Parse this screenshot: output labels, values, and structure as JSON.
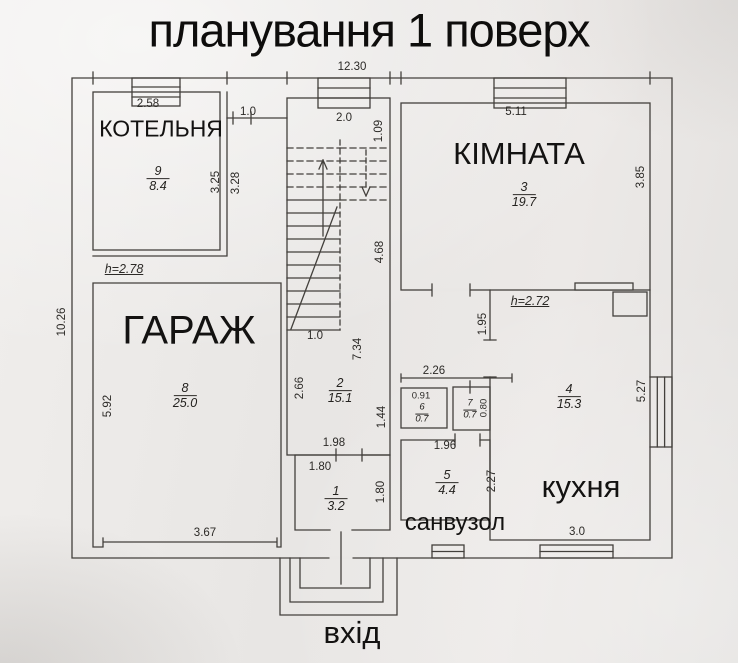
{
  "title": "планування 1 поверх",
  "entrance": {
    "label": "вхід"
  },
  "rooms": {
    "kotelnya": {
      "name": "КОТЕЛЬНЯ",
      "number": "9",
      "area": "8.4",
      "height": "h=2.78"
    },
    "kimnata": {
      "name": "КІМНАТА",
      "number": "3",
      "area": "19.7"
    },
    "garage": {
      "name": "ГАРАЖ",
      "number": "8",
      "area": "25.0"
    },
    "kitchen": {
      "name": "кухня",
      "number": "4",
      "area": "15.3",
      "height": "h=2.72"
    },
    "sanvuzol": {
      "name": "санвузол",
      "number": "5",
      "area": "4.4"
    },
    "hall": {
      "number": "2",
      "area": "15.1"
    },
    "tambour": {
      "number": "1",
      "area": "3.2"
    },
    "closet6": {
      "number": "6",
      "area": "0.7"
    },
    "closet7": {
      "number": "7",
      "area": "0.7"
    }
  },
  "dims": {
    "total_width": "12.30",
    "total_height": "10.26",
    "kotelnya_width": "2.58",
    "niche_width": "1.0",
    "stairs_width": "2.0",
    "kimnata_width": "5.11",
    "kimnata_depth": "3.85",
    "stairs_top_offset": "1.09",
    "kotelnya_depth_inner": "3.25",
    "kotelnya_depth_outer": "3.28",
    "stairs_flight_length": "4.68",
    "stairs_bottom_width": "1.0",
    "hall_length": "7.34",
    "hall_width": "2.66",
    "kitchen_door_offset": "1.95",
    "hall_right_segment": "1.44",
    "hall_bottom_width": "1.98",
    "closets_total_width": "2.26",
    "closet6_width": "0.91",
    "closet7_depth": "0.80",
    "garage_depth": "5.92",
    "garage_door_width": "3.67",
    "tambour_width": "1.80",
    "tambour_depth": "1.80",
    "sanvuzol_width": "1.96",
    "sanvuzol_depth": "2.27",
    "kitchen_depth": "5.27",
    "kitchen_window_width": "3.0"
  }
}
